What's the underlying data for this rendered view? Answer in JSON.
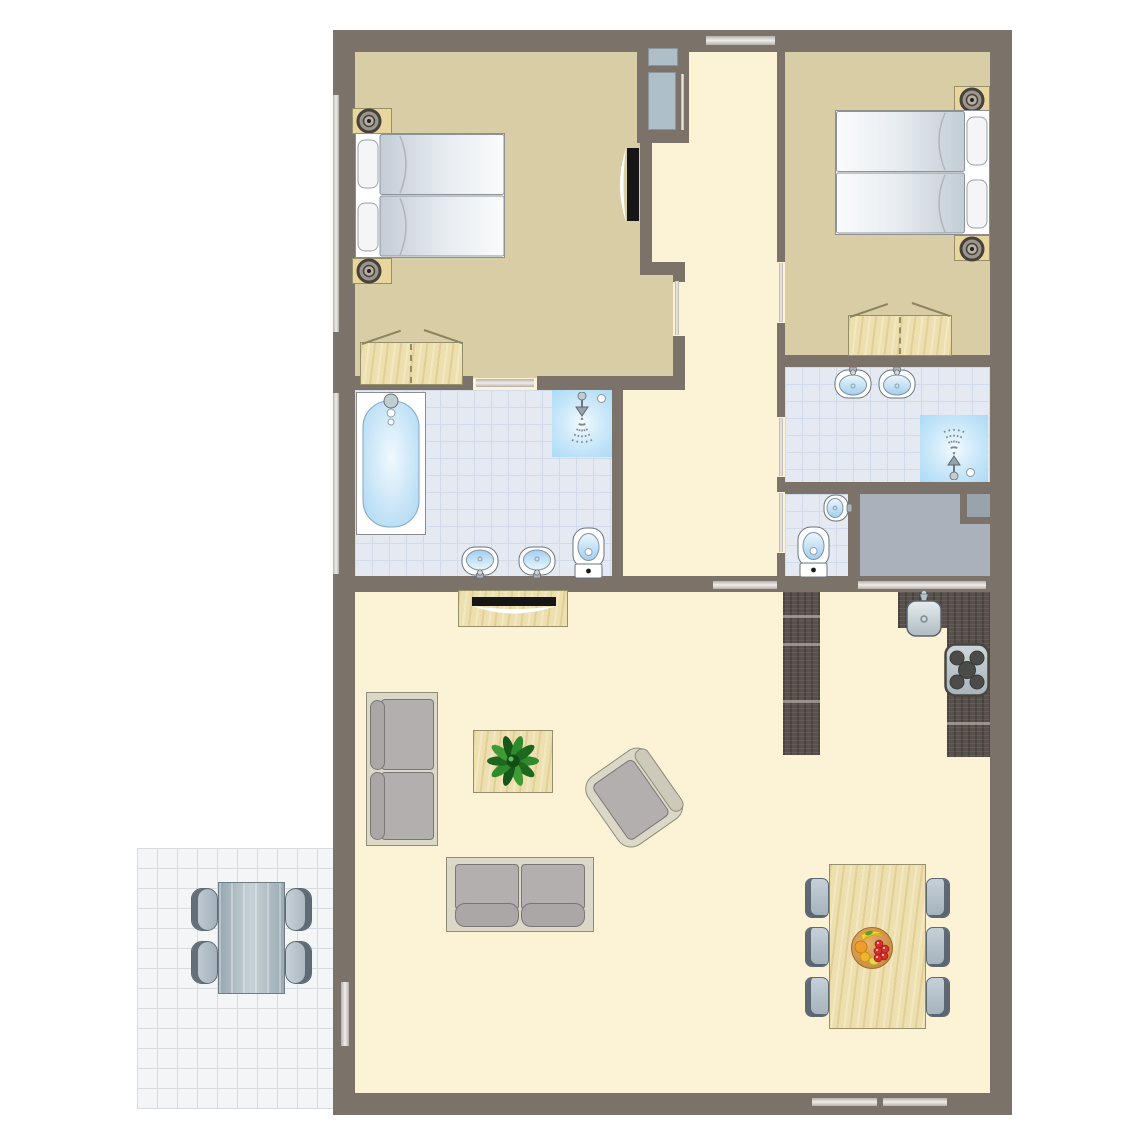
{
  "canvas": {
    "width": 1145,
    "height": 1145
  },
  "palette": {
    "wall": "#7b7269",
    "floor_cream": "#fcf3d6",
    "floor_tan": "#d9cda6",
    "tile": "#e4e9f2",
    "tile_line": "#d2dbea",
    "terrace": "#f4f5f7",
    "terrace_line": "#d7dce1",
    "storage": "#a9b2ba",
    "storage_dark": "#98a3ab",
    "wood_light": "#eedfae",
    "wood_edge": "#95906a",
    "wood_dark": "#57504b",
    "glass": "#f0eeea",
    "glass_edge": "#b5afa9",
    "shelf_blue": "#aebfc9",
    "sofa_frame": "#dbd8c7",
    "sofa_frame_edge": "#8f8c7a",
    "sofa_gray": "#b4afaf",
    "sofa_gray_edge": "#7b7676",
    "chair_face": "#b7c3cd",
    "chair_edge": "#5e6872",
    "tv_black": "#161616",
    "water_blue": "#a5d3f1",
    "plant_green": "#2f8a2c",
    "fruit_red": "#d5312a",
    "fruit_orange": "#f09c2c",
    "fruit_yellow": "#f4d22c"
  },
  "inventory": {
    "rooms": [
      "bedroom-left",
      "bedroom-right",
      "bathroom-ensuite",
      "bathroom-right",
      "wc",
      "storage-room",
      "hallway",
      "living-room",
      "kitchen",
      "dining-area",
      "terrace"
    ],
    "furniture": [
      "double-bed",
      "pillow",
      "nightstand",
      "table-lamp",
      "wardrobe",
      "wall-tv",
      "hall-closet",
      "bathtub",
      "shower",
      "washbasin",
      "toilet",
      "tv-cabinet",
      "television",
      "sofa",
      "armchair",
      "coffee-table",
      "potted-plant",
      "kitchen-island",
      "kitchen-counter",
      "kitchen-sink",
      "cooktop",
      "dining-table",
      "dining-chair",
      "fruit-bowl",
      "terrace-table",
      "terrace-chair"
    ],
    "openings": [
      "entrance-door",
      "bedroom-door",
      "bathroom-door",
      "wc-door",
      "sliding-terrace-door",
      "window"
    ]
  }
}
